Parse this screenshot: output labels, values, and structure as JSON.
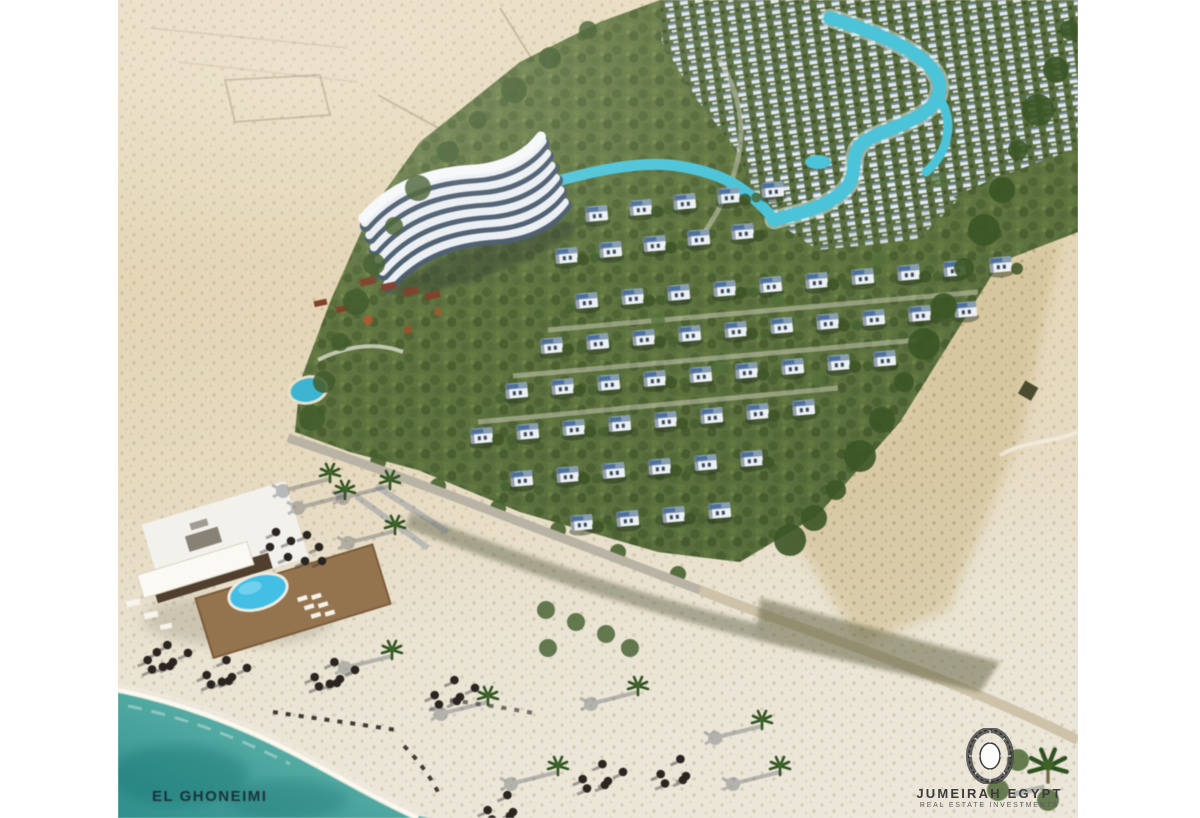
{
  "image": {
    "alt": "Aerial 3D rendering of a beachfront resort master plan with white villas, winding lagoon, curved hotel, beach club and turquoise sea",
    "kind": "architectural-render-photo"
  },
  "credits": {
    "architect": "EL GHONEIMI",
    "developer_name": "JUMEIRAH EGYPT",
    "developer_tagline": "REAL ESTATE INVESTMENTS",
    "developer_logo_icon": "diamond-gem-icon"
  },
  "palette": {
    "sea_deep": "#2f8f8c",
    "sea_shore": "#8fcac0",
    "lagoon": "#4ec3d8",
    "pool": "#46bfe6",
    "sand_desert": "#e3d5b4",
    "sand_beach": "#ece7da",
    "foliage_dark": "#3a5426",
    "foliage_light": "#66793f",
    "villa_white": "#eef2f6",
    "roof_blue": "#4a6fa0",
    "road_grey": "#b9b4a6",
    "deck_brown": "#93744f"
  }
}
